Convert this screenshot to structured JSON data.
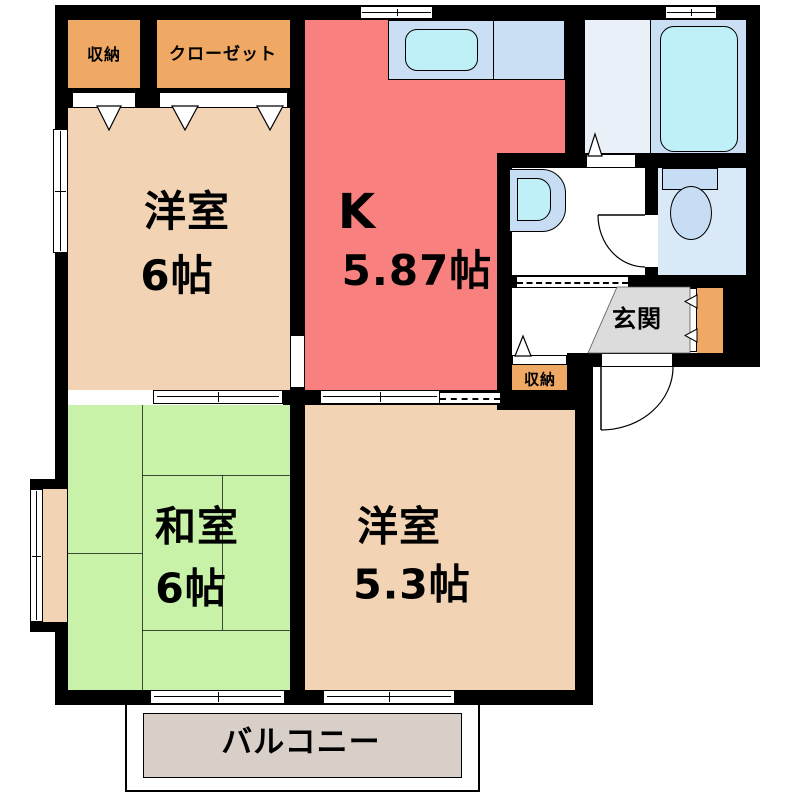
{
  "title": "間取り図",
  "rooms": {
    "storage_top": {
      "name": "収納"
    },
    "closet": {
      "name": "クローゼット"
    },
    "western1": {
      "name": "洋室",
      "area": "6帖"
    },
    "kitchen": {
      "name": "K",
      "area": "5.87帖"
    },
    "washitsu": {
      "name": "和室",
      "area": "6帖"
    },
    "western2": {
      "name": "洋室",
      "area": "5.3帖"
    },
    "entrance": {
      "name": "玄関"
    },
    "storage_hall": {
      "name": "収納"
    },
    "balcony": {
      "name": "バルコニー"
    }
  },
  "fixtures": [
    "bathtub",
    "kitchen-sink",
    "washbasin",
    "toilet",
    "bay-window",
    "windows",
    "sliding-doors",
    "door-swing-arcs",
    "shoe-cabinet"
  ],
  "colors": {
    "wall": "#000000",
    "western_room": "#F2D4B5",
    "kitchen": "#F8807E",
    "japanese_room": "#C7F2A7",
    "storage": "#F0A964",
    "bath_floor": "#EAF0F8",
    "bath_tub_area": "#CBDFF4",
    "tub": "#BFEFF7",
    "counter": "#CBDFF4",
    "sink": "#BFEFF7",
    "toilet_room": "#D9E9F8",
    "fixture_blue": "#C6DDF3",
    "entrance_floor": "#DCDCDC",
    "balcony_floor": "#D9CFC9",
    "washroom_floor": "#FFFFFF"
  }
}
